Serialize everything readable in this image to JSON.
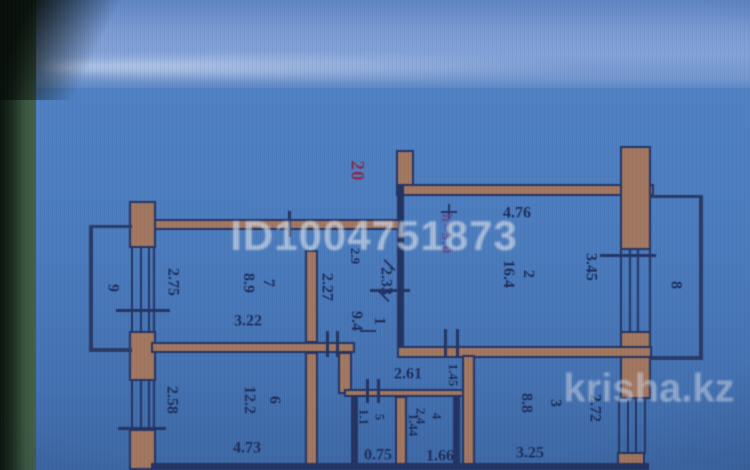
{
  "watermarks": {
    "listing_id": "ID1004751873",
    "brand": "krisha.kz"
  },
  "plan": {
    "apartment_number": "20",
    "ceiling_height": "h=3.0",
    "rooms": {
      "r1": {
        "number": "1",
        "area": "9.4"
      },
      "r2": {
        "number": "2",
        "area": "16.4"
      },
      "r3": {
        "number": "3",
        "area": "8.8"
      },
      "r4": {
        "number": "4",
        "area": "2.4"
      },
      "r5": {
        "number": "5",
        "area": "1.1"
      },
      "r6": {
        "number": "6",
        "area": "12.2"
      },
      "r7": {
        "number": "7",
        "area": "8.9"
      },
      "r8": {
        "number": "8"
      },
      "r9": {
        "number": "9"
      }
    },
    "dims": {
      "room2_top": "4.76",
      "room2_right": "3.45",
      "room7_left": "2.75",
      "room7_bottom": "3.22",
      "room6_left": "2.58",
      "room6_bottom": "4.73",
      "room3_right": "2.72",
      "room3_bottom": "3.25",
      "corridor_upper": "2.33",
      "closet_depth": "2.27",
      "niche": "2.9",
      "hall_width": "2.61",
      "hall_side": "1.45",
      "wc_width": "0.75",
      "bath_width": "1.66",
      "bath_depth": "1.44"
    }
  },
  "colors": {
    "background_blue": "#4a7bbd",
    "top_band_blue": "#7d9cd4",
    "line_navy": "#233463",
    "wall_fill_brown": "#a3775f",
    "watermark_gray": "#d2dae8",
    "apartment_number_red": "#8b2c4e",
    "height_note_purple": "#6a4a8a",
    "side_strip_green": "#3c5740"
  }
}
